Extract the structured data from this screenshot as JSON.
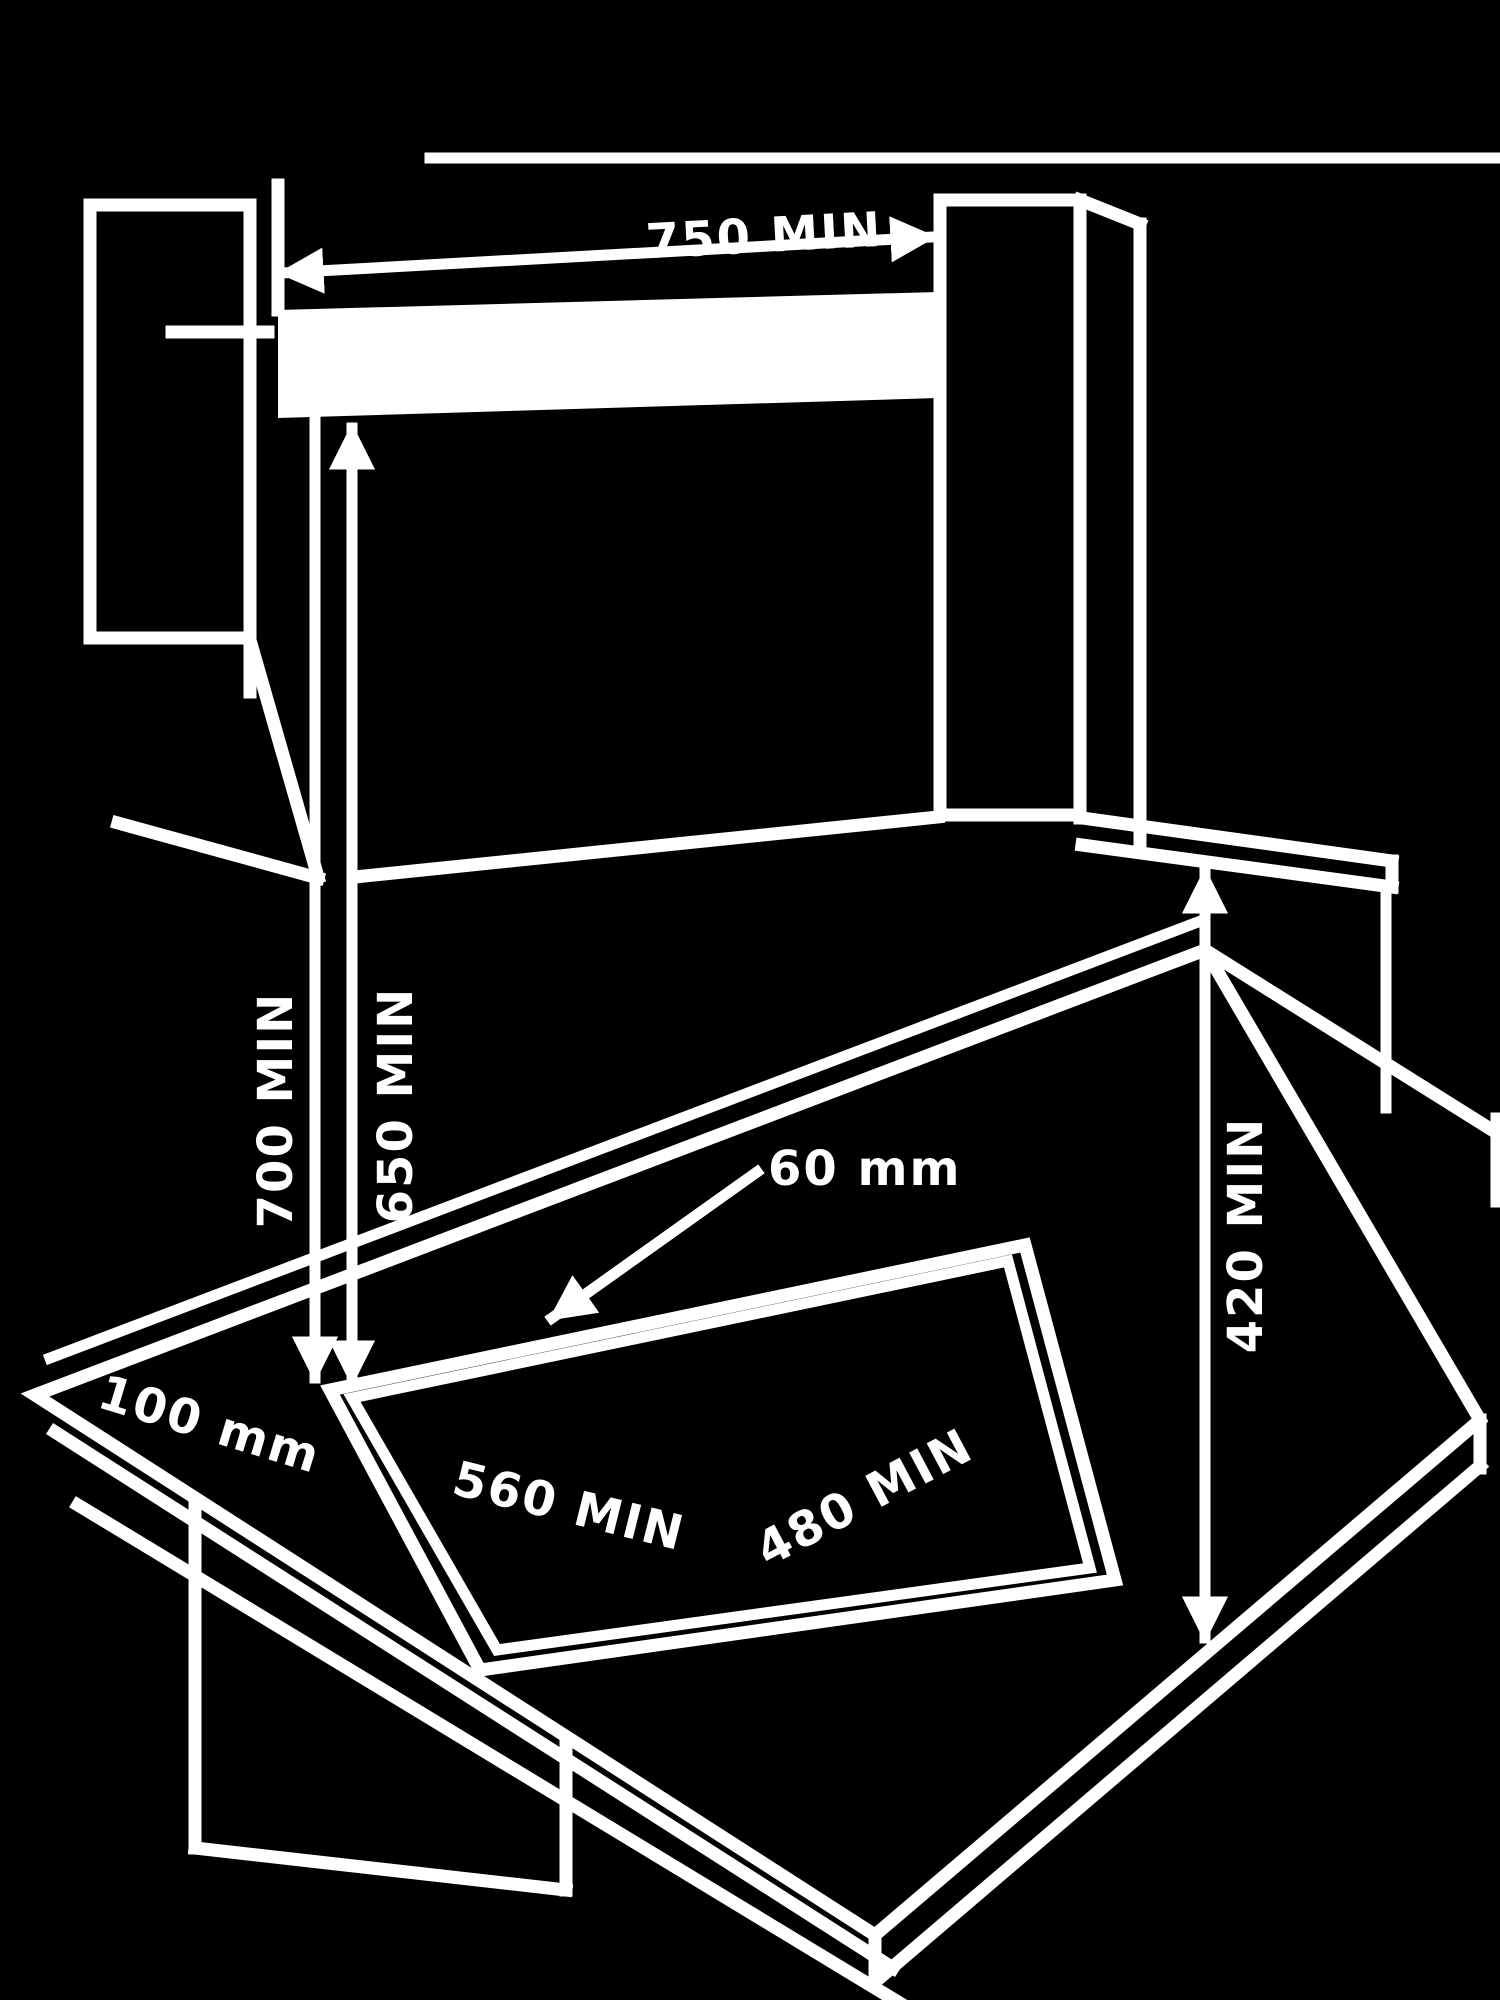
{
  "figure": {
    "name": "hob-installation-clearance-diagram",
    "style": "inverted-line-art",
    "colors": {
      "background": "#000000",
      "line": "#ffffff"
    }
  },
  "labels": {
    "niche_width": "750 MIN",
    "height_without_hood": "700 MIN",
    "height_with_hood": "650 MIN",
    "side_cabinet_height": "420 MIN",
    "rear_gap": "60 mm",
    "side_gap": "100 mm",
    "cutout_width": "560 MIN",
    "cutout_depth": "480 MIN"
  }
}
